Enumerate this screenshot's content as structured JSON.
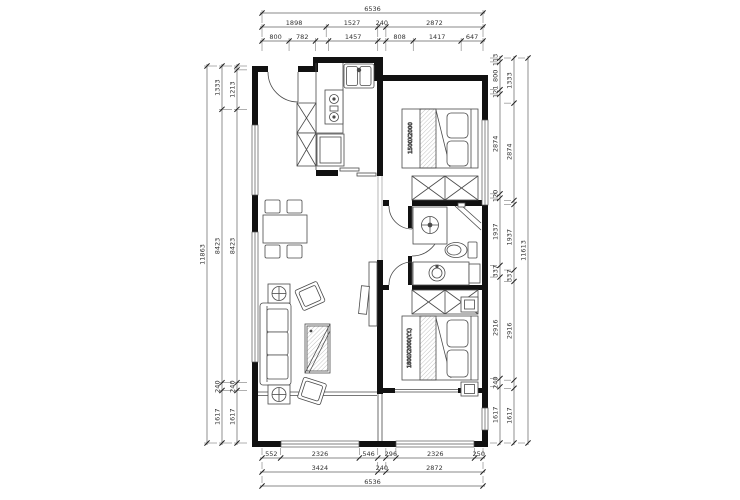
{
  "plan": {
    "bed1_label": "1500X2000",
    "bed2_label": "1800X2000(Y.Y.)"
  },
  "colors": {
    "wall": "#111111",
    "furniture_line": "#4a4a4a",
    "dim_line": "#606060",
    "dim_text": "#333333",
    "tick": "#222222"
  },
  "dimensions": {
    "strips": [
      {
        "name": "top-total",
        "dir": "h",
        "at": 13,
        "from": 262,
        "len": 221,
        "segments": [
          {
            "mm": 6536,
            "label": "6536"
          }
        ]
      },
      {
        "name": "top-mid",
        "dir": "h",
        "at": 27,
        "from": 262,
        "len": 221,
        "segments": [
          {
            "mm": 1898,
            "label": "1898"
          },
          {
            "mm": 1527,
            "label": "1527"
          },
          {
            "mm": 240,
            "label": "240"
          },
          {
            "mm": 2872,
            "label": "2872"
          }
        ]
      },
      {
        "name": "top-inner",
        "dir": "h",
        "at": 41,
        "from": 262,
        "len": 221,
        "segments": [
          {
            "mm": 800,
            "label": "800"
          },
          {
            "mm": 782,
            "label": "782"
          },
          {
            "mm": 385,
            "label": ""
          },
          {
            "mm": 1457,
            "label": "1457"
          },
          {
            "mm": 240,
            "label": ""
          },
          {
            "mm": 808,
            "label": "808"
          },
          {
            "mm": 1417,
            "label": "1417"
          },
          {
            "mm": 647,
            "label": "647"
          }
        ]
      },
      {
        "name": "bottom-inner",
        "dir": "h",
        "at": 458,
        "from": 262,
        "len": 221,
        "segments": [
          {
            "mm": 552,
            "label": "552"
          },
          {
            "mm": 2326,
            "label": "2326"
          },
          {
            "mm": 546,
            "label": "546"
          },
          {
            "mm": 240,
            "label": ""
          },
          {
            "mm": 296,
            "label": "296"
          },
          {
            "mm": 2326,
            "label": "2326"
          },
          {
            "mm": 250,
            "label": "250"
          }
        ]
      },
      {
        "name": "bottom-mid",
        "dir": "h",
        "at": 472,
        "from": 262,
        "len": 221,
        "segments": [
          {
            "mm": 3424,
            "label": "3424"
          },
          {
            "mm": 240,
            "label": "240"
          },
          {
            "mm": 2872,
            "label": "2872"
          }
        ]
      },
      {
        "name": "bottom-total",
        "dir": "h",
        "at": 486,
        "from": 262,
        "len": 221,
        "segments": [
          {
            "mm": 6536,
            "label": "6536"
          }
        ]
      },
      {
        "name": "left-total",
        "dir": "v",
        "at": 207,
        "from": 66,
        "len": 377,
        "segments": [
          {
            "mm": 11863,
            "label": "11863"
          }
        ]
      },
      {
        "name": "left-mid",
        "dir": "v",
        "at": 222,
        "from": 66,
        "len": 377,
        "segments": [
          {
            "mm": 1333,
            "label": "1333"
          },
          {
            "mm": 8423,
            "label": "8423"
          },
          {
            "mm": 240,
            "label": "240"
          },
          {
            "mm": 1617,
            "label": "1617"
          }
        ]
      },
      {
        "name": "left-inner",
        "dir": "v",
        "at": 237,
        "from": 66,
        "len": 377,
        "segments": [
          {
            "mm": 120,
            "label": ""
          },
          {
            "mm": 1213,
            "label": "1213"
          },
          {
            "mm": 8423,
            "label": "8423"
          },
          {
            "mm": 240,
            "label": "240"
          },
          {
            "mm": 1617,
            "label": "1617"
          }
        ]
      },
      {
        "name": "right-inner",
        "dir": "v",
        "at": 500,
        "from": 58,
        "len": 385,
        "segments": [
          {
            "mm": 113,
            "label": "113"
          },
          {
            "mm": 800,
            "label": "800"
          },
          {
            "mm": 121,
            "label": "121"
          },
          {
            "mm": 2874,
            "label": "2874"
          },
          {
            "mm": 120,
            "label": "120"
          },
          {
            "mm": 1937,
            "label": "1937"
          },
          {
            "mm": 337,
            "label": "337"
          },
          {
            "mm": 2916,
            "label": "2916"
          },
          {
            "mm": 240,
            "label": "240"
          },
          {
            "mm": 1617,
            "label": "1617"
          }
        ]
      },
      {
        "name": "right-mid",
        "dir": "v",
        "at": 514,
        "from": 58,
        "len": 385,
        "segments": [
          {
            "mm": 1333,
            "label": "1333"
          },
          {
            "mm": 2874,
            "label": "2874"
          },
          {
            "mm": 120,
            "label": ""
          },
          {
            "mm": 1937,
            "label": "1937"
          },
          {
            "mm": 337,
            "label": "337"
          },
          {
            "mm": 2916,
            "label": "2916"
          },
          {
            "mm": 240,
            "label": ""
          },
          {
            "mm": 1617,
            "label": "1617"
          }
        ]
      },
      {
        "name": "right-total",
        "dir": "v",
        "at": 528,
        "from": 58,
        "len": 385,
        "segments": [
          {
            "mm": 11613,
            "label": "11613"
          }
        ]
      }
    ]
  }
}
